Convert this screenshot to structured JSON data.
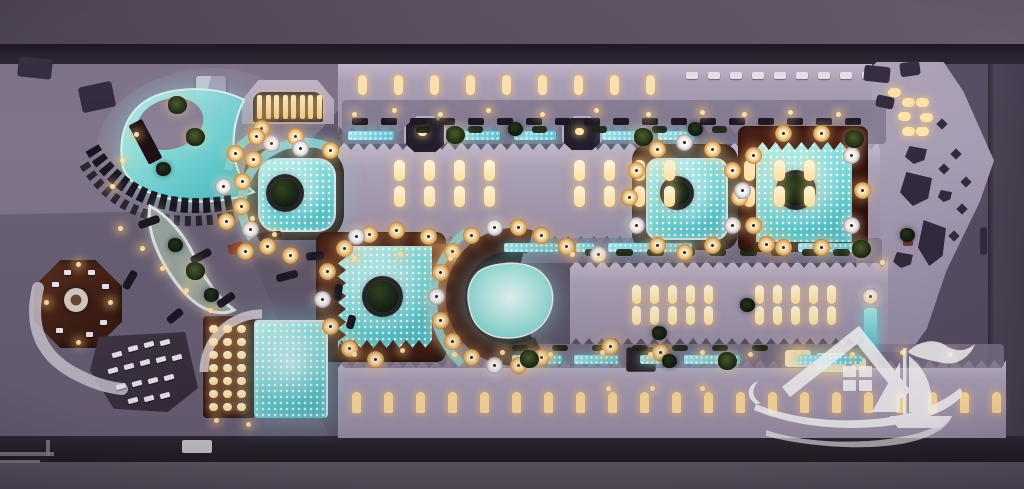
{
  "meta": {
    "type": "aerial-night-photograph",
    "description": "Top-down aerial drone photo at dusk of an illuminated beach-club resort: turquoise glowing pools with tree islands, arcs of amber-lit umbrellas, lavender zig-zag rooftops with glowing skylights, wooden decks, dark streets framing the top and bottom, and a semi-transparent white beach-house & sailboat logo watermark at the lower right."
  },
  "colors": {
    "road_top": "#584e5d",
    "wall": "#241f28",
    "ground": "#5e5569",
    "ground_light": "#7f7489",
    "roof": "#aca1b6",
    "roof_lit": "#c4bacb",
    "plaza": "#b2a8bc",
    "wood": "#3c1c12",
    "wood_lit": "#96522b",
    "water": "#58c8cb",
    "water_bright": "#b9f1ec",
    "water_soft": "#bfe9e4",
    "channel": "#7fd2dc",
    "umbrella": "#f4d396",
    "umbrella_rim": "#7c4d22",
    "light_warm": "#ffe2a8",
    "window_warm": "#ffe6ad",
    "hedge": "#1c2410",
    "lounger": "#e9e4ea",
    "structure_dark": "#241e2c",
    "logo_white": "#ffffff"
  },
  "regions": {
    "top_street": {
      "label": "street above the resort"
    },
    "perimeter_wall": {
      "label": "dark perimeter wall"
    },
    "grounds": {
      "label": "resort grounds at dusk"
    },
    "crescent_pool": {
      "label": "crescent pool with arc of loungers"
    },
    "arch_cabana": {
      "label": "arched cabana with lit daybeds"
    },
    "round_pool": {
      "label": "rounded pool with tree island and lazy-river arc"
    },
    "west_pool": {
      "label": "west square pool with tree island"
    },
    "lagoon_pool": {
      "label": "lagoon pool ringed by umbrellas"
    },
    "ring_pool": {
      "label": "pool encircled by umbrellas"
    },
    "grand_pool": {
      "label": "grand east pool with island"
    },
    "south_pool": {
      "label": "south rectangular pool with deck house"
    },
    "octagon_bar": {
      "label": "octagonal wooden bar deck"
    },
    "fan_terrace": {
      "label": "fan-shaped dining terrace"
    },
    "palm_planter": {
      "label": "bow-tie palm planter"
    },
    "north_roof": {
      "label": "north rooftop with skylights"
    },
    "central_roof": {
      "label": "central rooftop with skylights"
    },
    "east_roof": {
      "label": "east rooftop with skylights"
    },
    "south_roof": {
      "label": "south rooftop with arched windows"
    },
    "east_plaza": {
      "label": "east plaza with planters"
    },
    "pavilion_a": {
      "label": "walkway pavilion"
    },
    "pavilion_b": {
      "label": "walkway pavilion"
    },
    "garden_hut": {
      "label": "small garden hut"
    },
    "waterfall": {
      "label": "glowing water feature"
    },
    "bottom_street": {
      "label": "street below the resort"
    }
  },
  "watermark": {
    "label": "beach house and sailboat logo watermark",
    "elements": [
      "house roof",
      "four-pane window",
      "rolling waves",
      "sailboat",
      "seagull"
    ]
  }
}
